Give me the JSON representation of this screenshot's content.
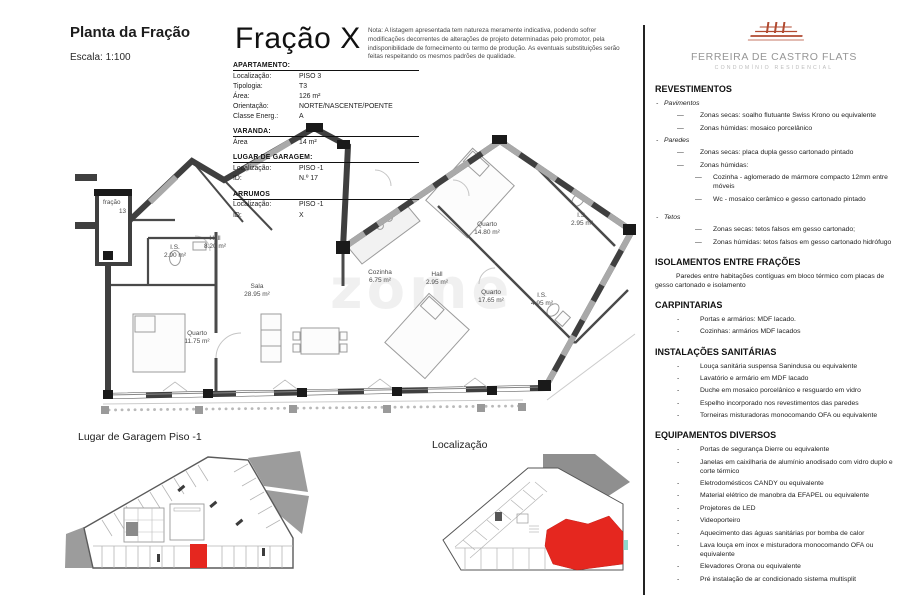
{
  "header": {
    "title": "Planta da Fração",
    "scale": "Escala: 1:100",
    "fraction_title": "Fração X",
    "note": "Nota: A listagem apresentada tem natureza meramente indicativa, podendo sofrer modificações decorrentes de alterações de projeto determinadas pelo promotor, pela indisponibilidade de fornecimento ou termo de produção. As eventuais substituições serão feitas respeitando os mesmos padrões de qualidade."
  },
  "info_tables": {
    "apartamento": {
      "title": "APARTAMENTO:",
      "rows": [
        {
          "label": "Localização:",
          "value": "PISO 3"
        },
        {
          "label": "Tipologia:",
          "value": "T3"
        },
        {
          "label": "Área:",
          "value": "126 m²"
        },
        {
          "label": "Orientação:",
          "value": "NORTE/NASCENTE/POENTE"
        },
        {
          "label": "Classe Energ.:",
          "value": "A"
        }
      ]
    },
    "varanda": {
      "title": "VARANDA:",
      "rows": [
        {
          "label": "Área",
          "value": "14 m²"
        }
      ]
    },
    "garagem": {
      "title": "LUGAR DE GARAGEM:",
      "rows": [
        {
          "label": "Localização:",
          "value": "PISO -1"
        },
        {
          "label": "ID:",
          "value": "N.º 17"
        }
      ]
    },
    "arrumos": {
      "title": "ARRUMOS",
      "rows": [
        {
          "label": "Localização:",
          "value": "PISO -1"
        },
        {
          "label": "ID:",
          "value": "X"
        }
      ]
    }
  },
  "plan": {
    "watermark": "zome",
    "neighbor_label": {
      "line1": "fração",
      "line2": "13"
    },
    "rooms": [
      {
        "name": "Hall",
        "area": "8.20 m²"
      },
      {
        "name": "I.S.",
        "area": "2.90 m²"
      },
      {
        "name": "Sala",
        "area": "28.95 m²"
      },
      {
        "name": "Quarto",
        "area": "11.75 m²"
      },
      {
        "name": "Cozinha",
        "area": "6.75 m²"
      },
      {
        "name": "Hall",
        "area": "2.95 m²"
      },
      {
        "name": "Quarto",
        "area": "14.80 m²"
      },
      {
        "name": "I.S.",
        "area": "2.95 m²"
      },
      {
        "name": "Quarto",
        "area": "17.65 m²"
      },
      {
        "name": "I.S.",
        "area": "4.95 m²"
      }
    ]
  },
  "bottom": {
    "garage_title": "Lugar de Garagem Piso -1",
    "location_title": "Localização"
  },
  "sidebar": {
    "brand": {
      "name": "FERREIRA DE CASTRO FLATS",
      "subtitle": "CONDOMÍNIO RESIDENCIAL"
    },
    "sections": [
      {
        "heading": "REVESTIMENTOS",
        "items": [
          {
            "cls": "l0",
            "b": "-",
            "t": "Pavimentos"
          },
          {
            "cls": "l1",
            "b": "—",
            "t": "Zonas secas: soalho flutuante Swiss Krono ou equivalente"
          },
          {
            "cls": "l1",
            "b": "—",
            "t": "Zonas húmidas: mosaico porcelânico"
          },
          {
            "cls": "l0",
            "b": "-",
            "t": "Paredes"
          },
          {
            "cls": "l1",
            "b": "—",
            "t": "Zonas secas: placa dupla gesso cartonado pintado"
          },
          {
            "cls": "l1",
            "b": "—",
            "t": "Zonas húmidas:"
          },
          {
            "cls": "l2",
            "b": "—",
            "t": "Cozinha - aglomerado de mármore compacto 12mm entre móveis"
          },
          {
            "cls": "l2",
            "b": "—",
            "t": "Wc - mosaico cerâmico e gesso cartonado pintado"
          },
          {
            "cls": "l0 gap",
            "b": "-",
            "t": "Tetos"
          },
          {
            "cls": "l2",
            "b": "—",
            "t": "Zonas secas: tetos falsos em gesso cartonado;"
          },
          {
            "cls": "l2",
            "b": "—",
            "t": "Zonas húmidas: tetos falsos em gesso cartonado hidrófugo"
          }
        ]
      },
      {
        "heading": "ISOLAMENTOS ENTRE FRAÇÕES",
        "items": [
          {
            "cls": "hang",
            "b": "-",
            "t": "Paredes entre habitações contíguas em bloco térmico com placas de gesso cartonado e isolamento"
          }
        ]
      },
      {
        "heading": "CARPINTARIAS",
        "items": [
          {
            "cls": "l1",
            "b": "-",
            "t": "Portas e armários: MDF lacado."
          },
          {
            "cls": "l1",
            "b": "-",
            "t": "Cozinhas: armários MDF lacados"
          }
        ]
      },
      {
        "heading": "INSTALAÇÕES SANITÁRIAS",
        "items": [
          {
            "cls": "l1",
            "b": "-",
            "t": "Louça sanitária suspensa Sanindusa ou equivalente"
          },
          {
            "cls": "l1",
            "b": "-",
            "t": "Lavatório e armário em MDF lacado"
          },
          {
            "cls": "l1",
            "b": "-",
            "t": "Duche em mosaico porcelânico e resguardo em vidro"
          },
          {
            "cls": "l1",
            "b": "-",
            "t": "Espelho incorporado nos revestimentos das paredes"
          },
          {
            "cls": "l1",
            "b": "-",
            "t": "Torneiras misturadoras monocomando OFA ou equivalente"
          }
        ]
      },
      {
        "heading": "EQUIPAMENTOS DIVERSOS",
        "items": [
          {
            "cls": "l1",
            "b": "-",
            "t": "Portas de segurança Dierre ou equivalente"
          },
          {
            "cls": "l1",
            "b": "-",
            "t": "Janelas em caixilharia de alumínio anodisado com vidro duplo e corte térmico"
          },
          {
            "cls": "l1",
            "b": "-",
            "t": "Eletrodomésticos CANDY ou equivalente"
          },
          {
            "cls": "l1",
            "b": "-",
            "t": "Material elétrico de manobra da EFAPEL ou equivalente"
          },
          {
            "cls": "l1",
            "b": "-",
            "t": "Projetores de LED"
          },
          {
            "cls": "l1",
            "b": "-",
            "t": "Videoporteiro"
          },
          {
            "cls": "l1",
            "b": "-",
            "t": "Aquecimento das águas sanitárias por bomba de calor"
          },
          {
            "cls": "l1",
            "b": "-",
            "t": "Lava louça em inox e misturadora monocomando OFA ou equivalente"
          },
          {
            "cls": "l1",
            "b": "-",
            "t": "Elevadores Orona ou equivalente"
          },
          {
            "cls": "l1",
            "b": "-",
            "t": "Pré instalação de ar condicionado sistema multisplit"
          }
        ]
      }
    ]
  },
  "colors": {
    "highlight_red": "#e5271f",
    "brand_red": "#b14a30",
    "wall_dark": "#3f3f3f",
    "window_gray": "#a9a9a9",
    "context_gray": "#9c9c9c",
    "divider": "#232323"
  }
}
